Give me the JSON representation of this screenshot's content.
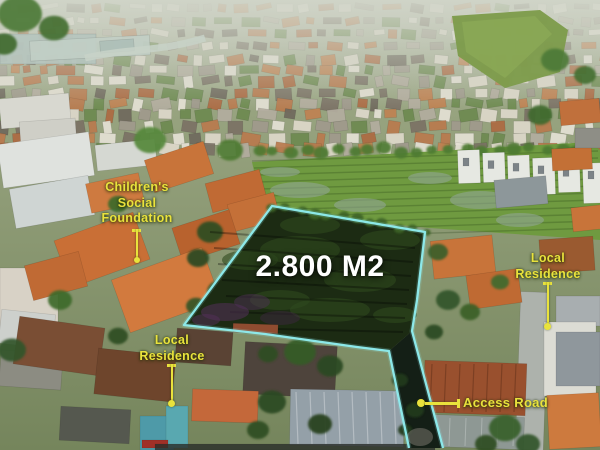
{
  "annotations": {
    "area": {
      "text": "2.800 M2"
    },
    "children_foundation": {
      "line1": "Children's",
      "line2": "Social",
      "line3": "Foundation"
    },
    "local_residence_left": {
      "line1": "Local",
      "line2": "Residence"
    },
    "local_residence_right": {
      "line1": "Local",
      "line2": "Residence"
    },
    "access_road": {
      "text": "Access Road"
    }
  },
  "colors": {
    "label_yellow": "#e9e23c",
    "plot_outline_cyan": "#8feef0",
    "area_text_white": "#ffffff"
  }
}
